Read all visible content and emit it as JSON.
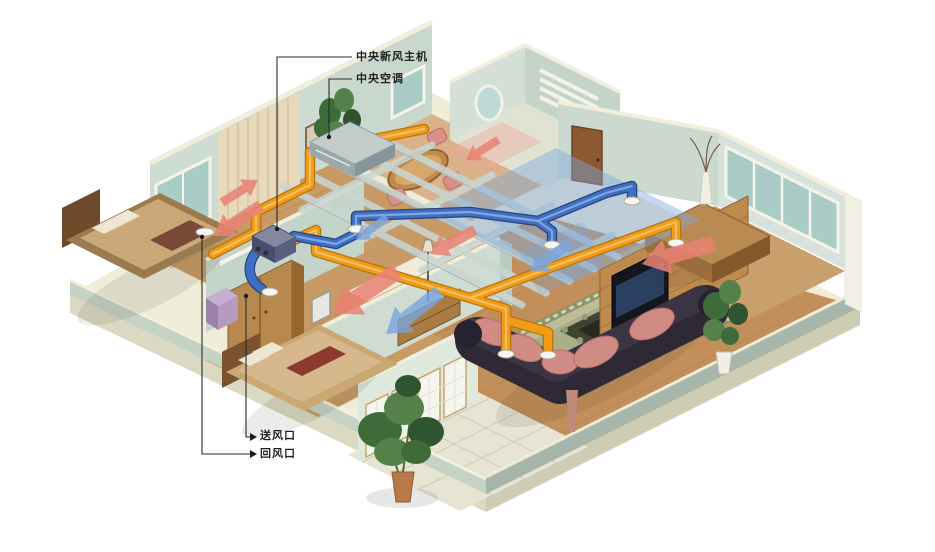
{
  "illustration": {
    "type": "isometric-apartment-hvac-cutaway",
    "callouts": {
      "fresh_air_unit": "中央新风主机",
      "central_ac": "中央空调",
      "supply_vent": "送风口",
      "return_vent": "回风口"
    },
    "colors": {
      "background": "#FFFFFF",
      "supply_duct_orange": "#F29B16",
      "fresh_air_duct_blue": "#3E6FC2",
      "warm_airflow_arrow": "#EA8275",
      "cool_airflow_arrow": "#7BA6DE",
      "unit_body": "#565A78",
      "ac_unit_body": "#9AA9A9",
      "wall_face": "#CDDCD3",
      "wall_top": "#F1EEDC",
      "wood_floor": "#C28E59",
      "tile_floor": "#E7E4D4",
      "leader_line": "#2B2B2B"
    }
  }
}
